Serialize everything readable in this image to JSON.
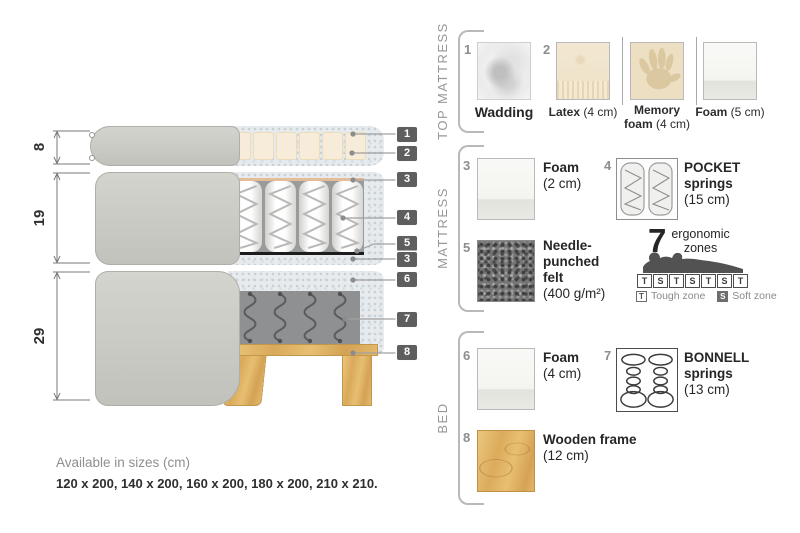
{
  "diagram": {
    "dimensions": [
      {
        "label": "8"
      },
      {
        "label": "19"
      },
      {
        "label": "29"
      }
    ],
    "callouts": [
      {
        "n": "1"
      },
      {
        "n": "2"
      },
      {
        "n": "3"
      },
      {
        "n": "4"
      },
      {
        "n": "5"
      },
      {
        "n": "3"
      },
      {
        "n": "6"
      },
      {
        "n": "7"
      },
      {
        "n": "8"
      }
    ]
  },
  "legend": {
    "top_mattress": {
      "title": "TOP MATTRESS",
      "wadding": {
        "num": "1",
        "name": "Wadding"
      },
      "latex": {
        "num": "2",
        "name": "Latex",
        "detail": "(4 cm)"
      },
      "memory": {
        "name": "Memory foam",
        "detail": "(4 cm)"
      },
      "foam": {
        "name": "Foam",
        "detail": "(5 cm)"
      }
    },
    "mattress": {
      "title": "MATTRESS",
      "foam": {
        "num": "3",
        "name": "Foam",
        "detail": "(2 cm)"
      },
      "pocket": {
        "num": "4",
        "name": "POCKET springs",
        "detail": "(15 cm)"
      },
      "felt": {
        "num": "5",
        "name": "Needle-punched felt",
        "detail": "(400 g/m²)"
      },
      "ergonomic": {
        "number": "7",
        "word1": "ergonomic",
        "word2": "zones",
        "zones": [
          "T",
          "S",
          "T",
          "S",
          "T",
          "S",
          "T"
        ],
        "tough_key": "T",
        "tough_label": "Tough zone",
        "soft_key": "S",
        "soft_label": "Soft zone"
      }
    },
    "bed": {
      "title": "BED",
      "foam": {
        "num": "6",
        "name": "Foam",
        "detail": "(4 cm)"
      },
      "bonnell": {
        "num": "7",
        "name": "BONNELL springs",
        "detail": "(13 cm)"
      },
      "frame": {
        "num": "8",
        "name": "Wooden frame",
        "detail": "(12 cm)"
      }
    }
  },
  "footer": {
    "title": "Available in sizes (cm)",
    "sizes": "120 x 200, 140 x 200, 160 x 200, 180 x 200, 210 x 210."
  },
  "colors": {
    "wood": "#dfb169",
    "callout_box": "#5e5e5e",
    "cover_gray": "#cbccc6"
  }
}
